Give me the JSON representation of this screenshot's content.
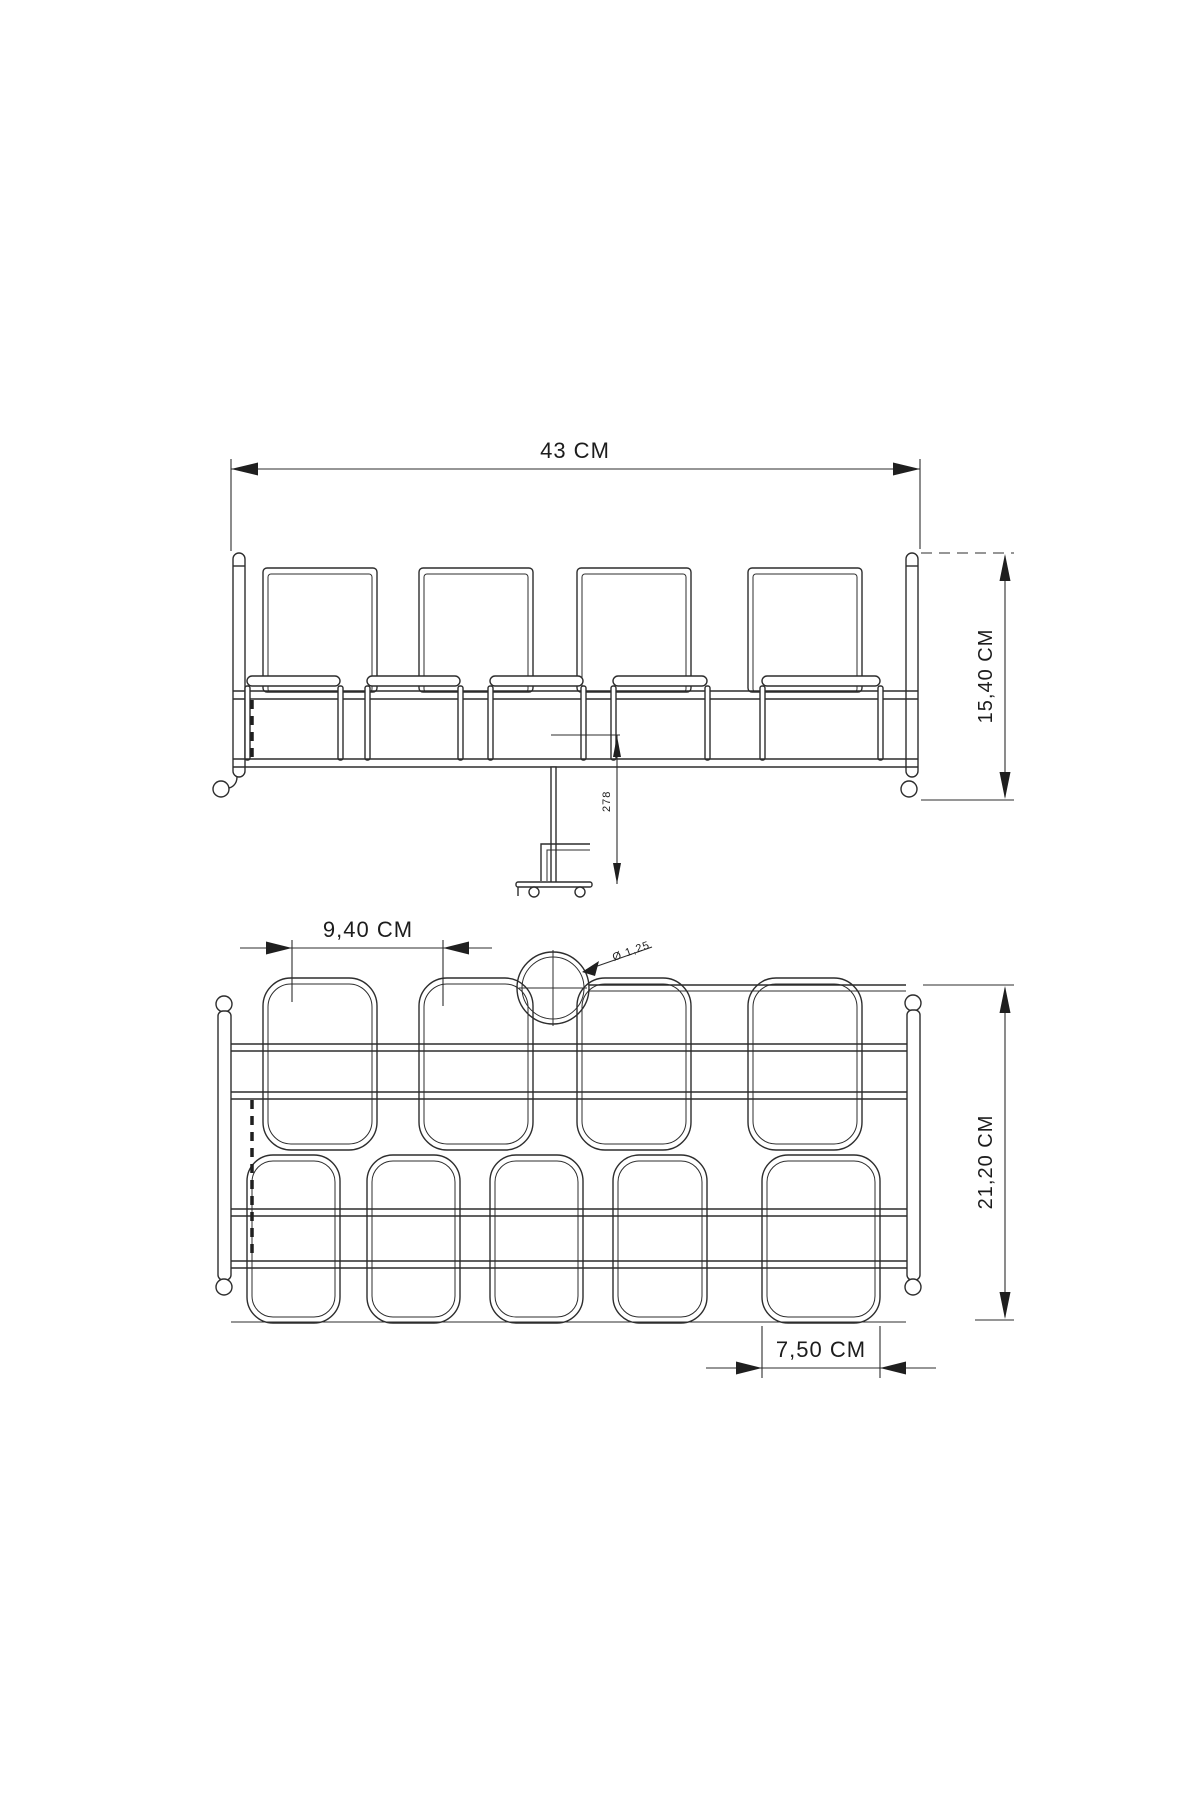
{
  "colors": {
    "background": "#ffffff",
    "line": "#2d2d2d",
    "text": "#1c1c1c"
  },
  "front_view": {
    "width_dim": "43 CM",
    "height_dim": "15,40 CM",
    "leg_detail_dim": "278"
  },
  "plan_view": {
    "pitch_dim": "9,40 CM",
    "depth_dim": "21,20 CM",
    "cup_width_dim": "7,50 CM",
    "wire_diameter_dim": "Ø 1,25"
  }
}
